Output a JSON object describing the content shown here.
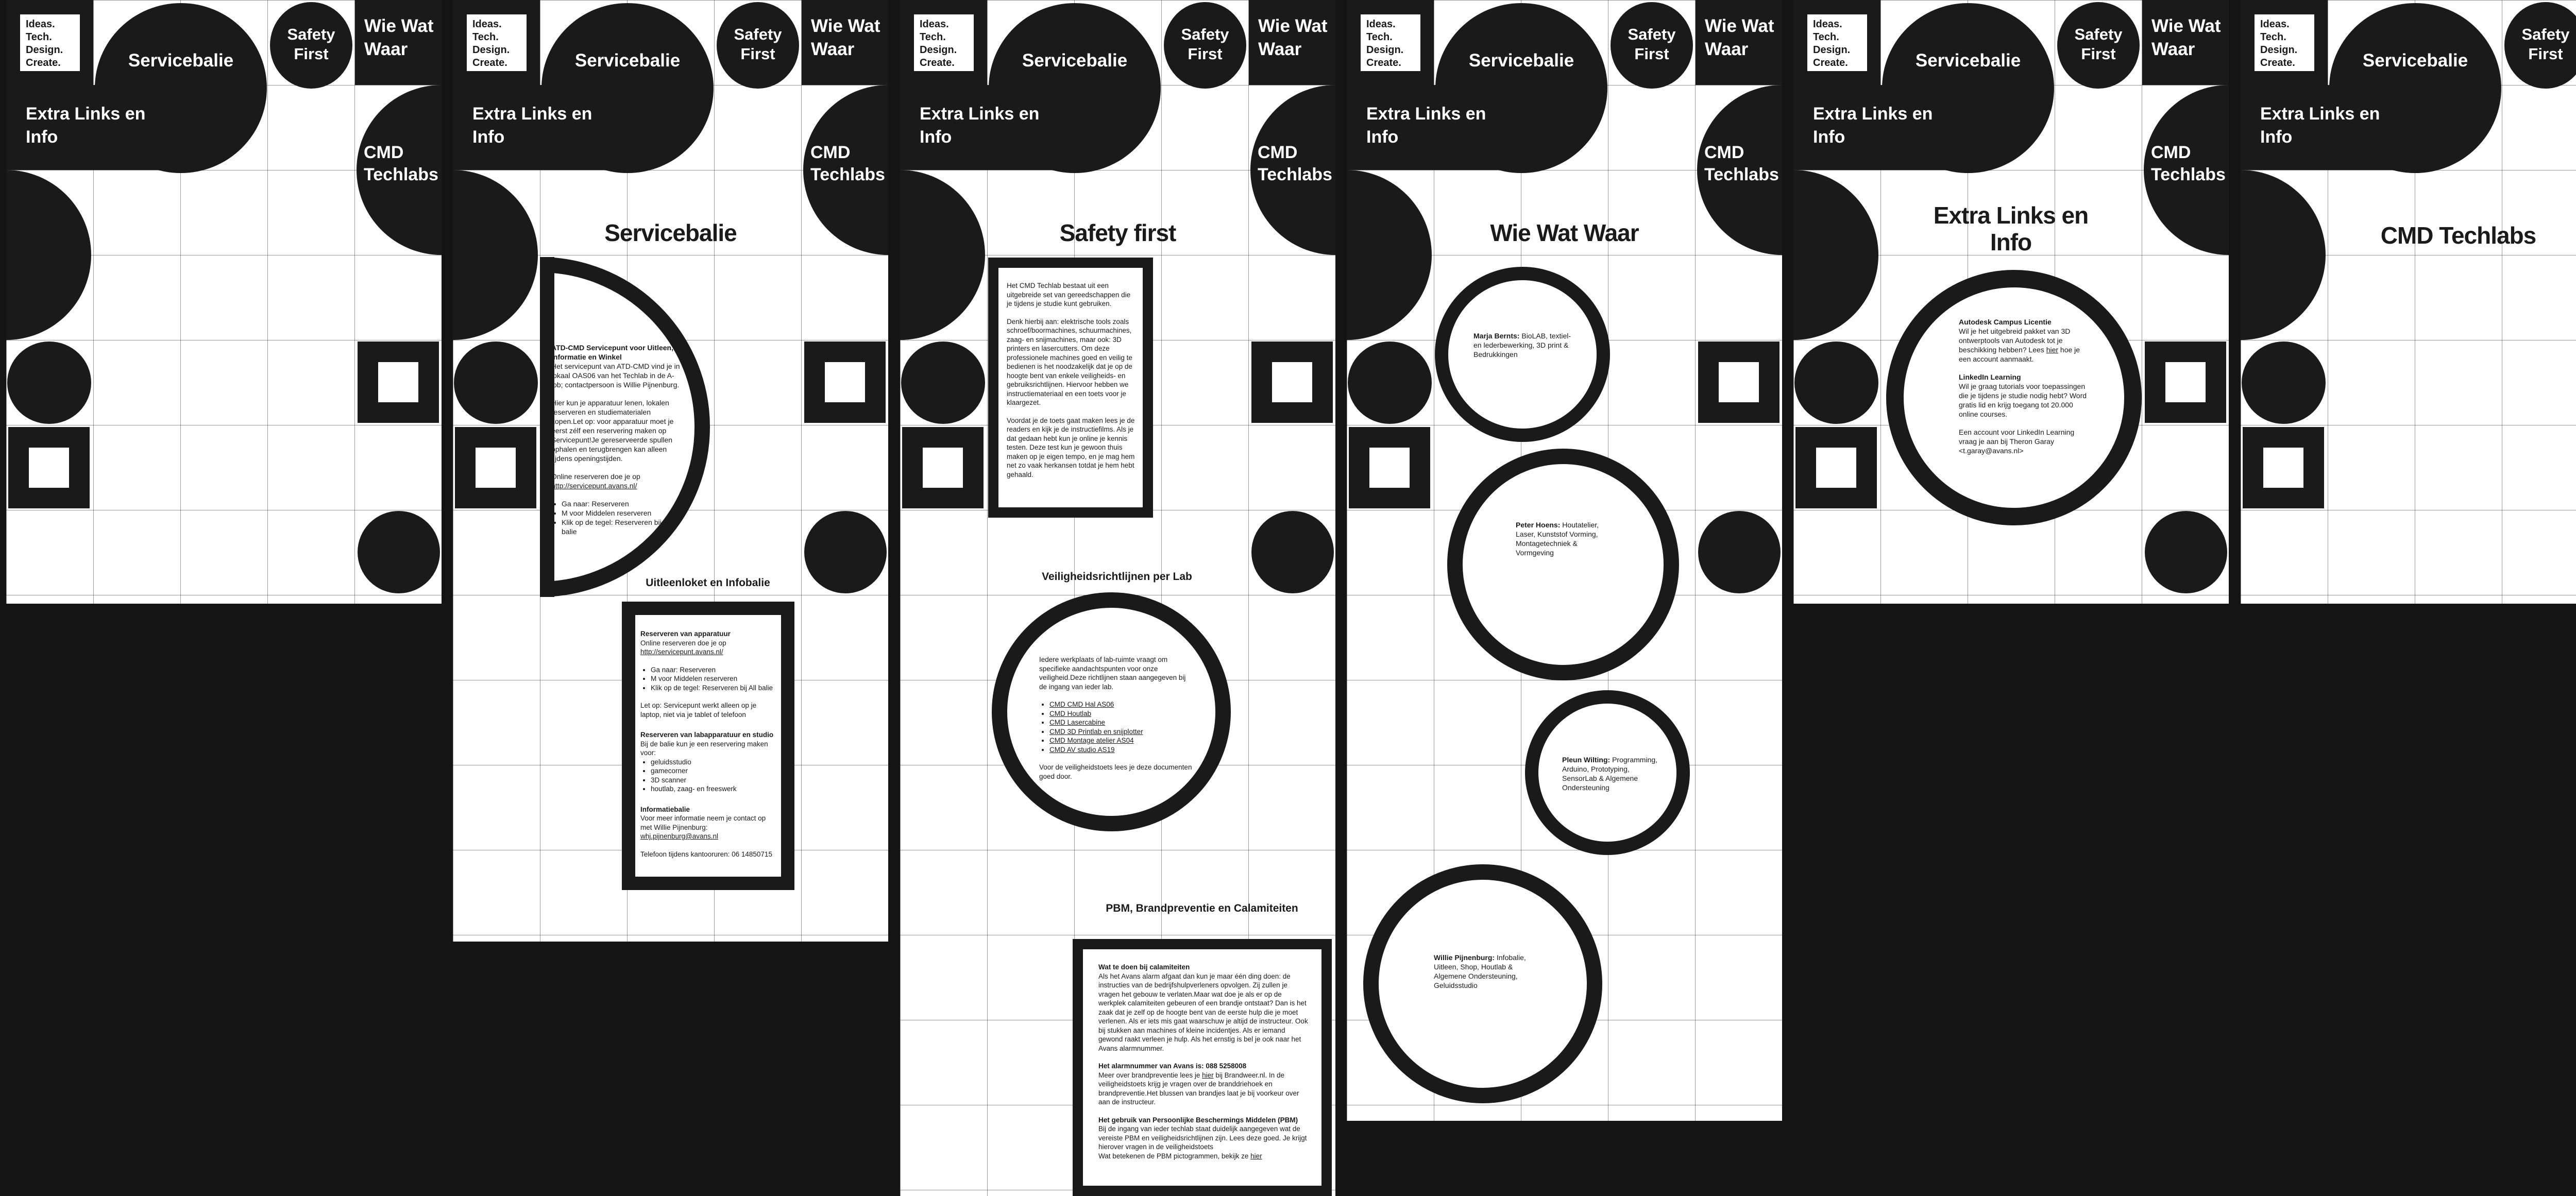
{
  "colors": {
    "ink": "#1a1a1a",
    "paper": "#ffffff",
    "background": "#141414"
  },
  "nav": {
    "logo_lines": [
      "Ideas.",
      "Tech.",
      "Design.",
      "Create."
    ],
    "servicebalie": "Servicebalie",
    "safety_first": "Safety First",
    "wie_wat_waar": "Wie Wat Waar",
    "extra_links": "Extra Links en Info",
    "cmd_techlabs": "CMD Techlabs"
  },
  "pages": {
    "servicebalie": {
      "title": "Servicebalie",
      "circle": {
        "heading": "ATD-CMD Servicepunt voor Uitleen, Informatie en Winkel",
        "p1": "Het servicepunt van ATD-CMD vind je in lokaal OAS06 van het Techlab in de A-lob; contactpersoon is Willie Pijnenburg.",
        "p2": "Hier kun je apparatuur lenen, lokalen reserveren en studiematerialen kopen.Let op: voor apparatuur moet je eerst zélf een reservering maken op Servicepunt!Je gereserveerde spullen ophalen en terugbrengen kan alleen tijdens openingstijden.",
        "p3_pre": "Online reserveren doe je op ",
        "p3_link": "http://servicepunt.avans.nl/",
        "bullets": [
          "Ga naar: Reserveren",
          "M voor Middelen reserveren",
          "Klik op de tegel: Reserveren bij CMD balie"
        ]
      },
      "section_heading": "Uitleenloket en Infobalie",
      "box": {
        "h1": "Reserveren van apparatuur",
        "p1_pre": "Online reserveren doe je op ",
        "p1_link": "http://servicepunt.avans.nl/",
        "bullets1": [
          "Ga naar: Reserveren",
          "M voor Middelen reserveren",
          "Klik op de tegel: Reserveren bij All balie"
        ],
        "note": "Let op: Servicepunt werkt alleen op je laptop, niet via je tablet of telefoon",
        "h2": "Reserveren van labapparatuur en studio",
        "p2": "Bij de balie kun je een reservering maken voor:",
        "bullets2": [
          "geluidsstudio",
          "gamecorner",
          "3D scanner",
          "houtlab, zaag- en freeswerk"
        ],
        "h3": "Informatiebalie",
        "p3": "Voor meer informatie neem je contact op met Willie Pijnenburg:",
        "email": "whj.pijnenburg@avans.nl",
        "p4": "Telefoon tijdens kantooruren: 06 14850715"
      }
    },
    "safety": {
      "title": "Safety first",
      "box1": {
        "p1": "Het CMD Techlab bestaat uit een uitgebreide set van gereedschappen die je tijdens je studie kunt gebruiken.",
        "p2": "Denk hierbij aan: elektrische tools zoals schroef/boormachines, schuurmachines, zaag- en snijmachines, maar ook: 3D printers en lasercutters. Om deze professionele machines goed en veilig te bedienen is het noodzakelijk dat je op de hoogte bent van enkele veiligheids- en gebruiksrichtlijnen. Hiervoor hebben we instructiemateriaal en een toets voor je klaargezet.",
        "p3": "Voordat je de toets gaat maken lees je de readers en kijk je de instructiefilms. Als je dat gedaan hebt kun je online je kennis testen. Deze test kun je gewoon thuis maken op je eigen tempo, en je mag hem net zo vaak herkansen totdat je hem hebt gehaald."
      },
      "section_heading1": "Veiligheidsrichtlijnen per Lab",
      "circle": {
        "p1": "Iedere werkplaats of lab-ruimte vraagt om specifieke aandachtspunten voor onze veiligheid.Deze richtlijnen staan aangegeven bij de ingang van ieder lab.",
        "links": [
          "CMD CMD Hal AS06",
          "CMD Houtlab",
          "CMD Lasercabine",
          "CMD 3D Printlab en snijplotter",
          "CMD Montage atelier AS04",
          "CMD AV studio AS19"
        ],
        "p2": "Voor de veiligheidstoets lees je deze documenten goed door."
      },
      "section_heading2": "PBM, Brandpreventie en Calamiteiten",
      "box2": {
        "h1": "Wat te doen bij calamiteiten",
        "p1": "Als het Avans alarm afgaat dan kun je maar één ding doen: de instructies van de bedrijfshulpverleners opvolgen. Zij zullen je vragen het gebouw te verlaten.Maar wat doe je als er op de werkplek calamiteiten gebeuren of een brandje ontstaat? Dan is het zaak dat je zelf op de hoogte bent van de eerste hulp die je moet verlenen. Als er iets mis gaat waarschuw je altijd de instructeur. Ook bij stukken aan machines of kleine incidentjes. Als er iemand gewond raakt verleen je hulp. Als het ernstig is bel je ook naar het Avans alarmnummer.",
        "h2": "Het alarmnummer van Avans is: 088 5258008",
        "p2_pre": "Meer over brandpreventie lees je ",
        "p2_link": "hier",
        "p2_post": " bij Brandweer.nl. In de veiligheidstoets krijg je vragen over de branddriehoek en brandpreventie.Het blussen van brandjes laat je bij voorkeur over aan de instructeur.",
        "h3": "Het gebruik van Persoonlijke Beschermings Middelen (PBM)",
        "p3": "Bij de ingang van ieder techlab staat duidelijk aangegeven wat de vereiste PBM en veiligheidsrichtlijnen zijn. Lees deze goed. Je krijgt hierover vragen in de veiligheidstoets",
        "p4_pre": "Wat betekenen de PBM pictogrammen, bekijk ze ",
        "p4_link": "hier"
      }
    },
    "wiewatwaar": {
      "title": "Wie Wat Waar",
      "persons": [
        {
          "name": "Marja Bernts:",
          "desc": " BioLAB, textiel- en lederbewerking, 3D print & Bedrukkingen"
        },
        {
          "name": "Peter Hoens:",
          "desc": " Houtatelier, Laser, Kunststof Vorming, Montagetechniek & Vormgeving"
        },
        {
          "name": "Pleun Wilting:",
          "desc": " Programming, Arduino, Prototyping, SensorLab & Algemene Ondersteuning"
        },
        {
          "name": "Willie Pijnenburg:",
          "desc": " Infobalie, Uitleen, Shop, Houtlab & Algemene Ondersteuning, Geluidsstudio"
        }
      ]
    },
    "extra": {
      "title": "Extra Links en Info",
      "circle": {
        "h1": "Autodesk Campus Licentie",
        "p1_pre": "Wil je het uitgebreid pakket van 3D ontwerptools van Autodesk tot je beschikking hebben? Lees ",
        "p1_link": "hier",
        "p1_post": " hoe je een account aanmaakt.",
        "h2": "LinkedIn Learning",
        "p2": "Wil je graag tutorials voor toepassingen die je tijdens je studie nodig hebt? Word gratis lid en krijg toegang tot 20.000 online courses.",
        "p3": "Een account voor LinkedIn Learning vraag je aan bij Theron Garay <t.garay@avans.nl>"
      }
    },
    "cmd": {
      "title": "CMD Techlabs"
    }
  }
}
